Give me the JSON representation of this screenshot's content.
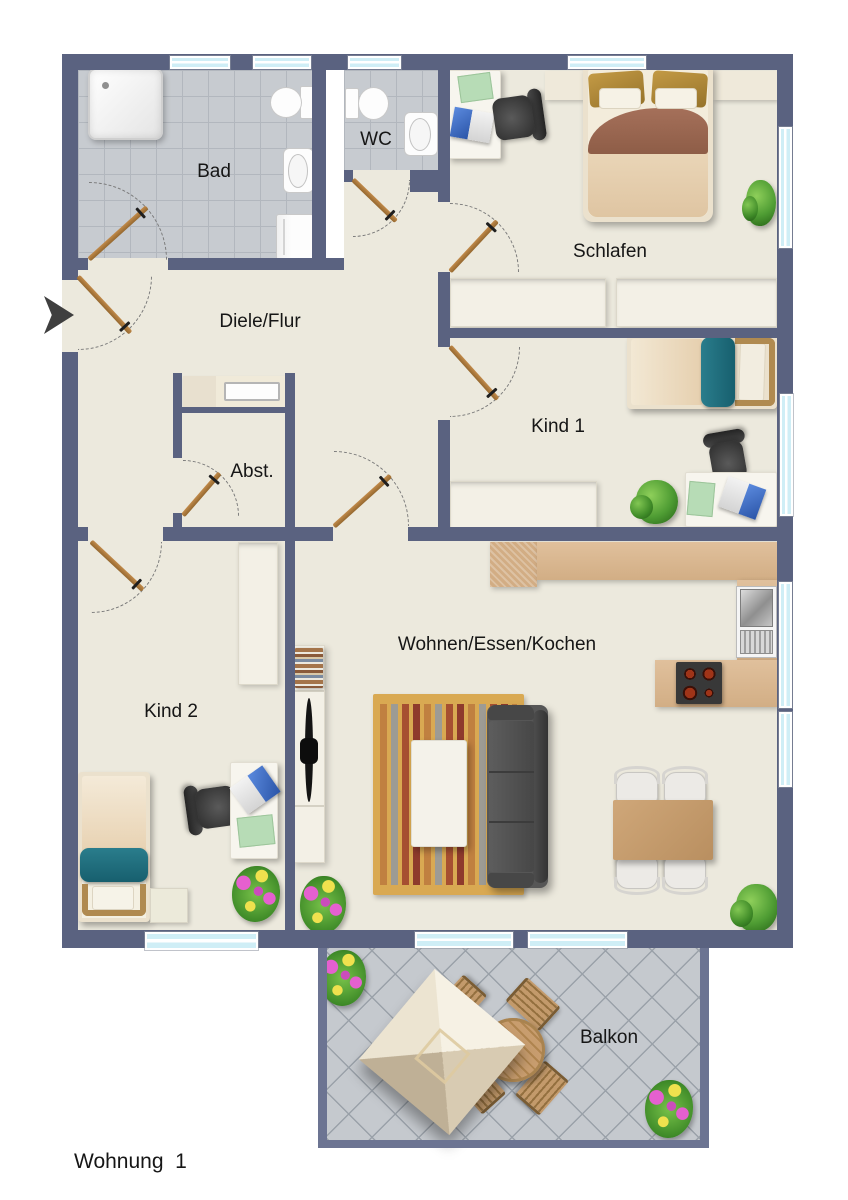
{
  "title": "Wohnung  1",
  "rooms": {
    "bad": "Bad",
    "wc": "WC",
    "schlafen": "Schlafen",
    "diele": "Diele/Flur",
    "abst": "Abst.",
    "kind1": "Kind 1",
    "kind2": "Kind 2",
    "wohnen": "Wohnen/Essen/Kochen",
    "balkon": "Balkon"
  },
  "icons": {
    "entrance": "entrance-arrow"
  },
  "colors": {
    "wall": "#5a6280",
    "balcony_wall": "#6c7492",
    "floor": "#ece9dd",
    "bath_tile": "#c7cbd0",
    "balcony_tile": "#c5c9ce",
    "window_glass": "#d9f2f8",
    "door_wood": "#ad7b3e",
    "kitchen_counter": "#d9b791",
    "teal_accent": "#1f6f80",
    "rug": "#d9a952",
    "sofa": "#565656"
  }
}
